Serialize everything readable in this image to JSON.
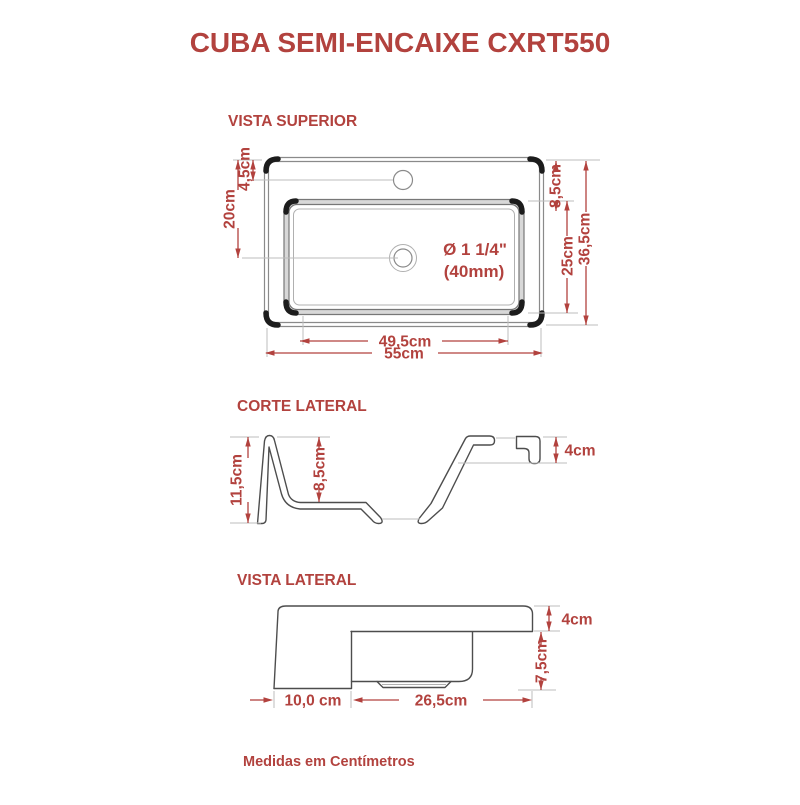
{
  "title": "CUBA SEMI-ENCAIXE CXRT550",
  "footer": "Medidas em Centímetros",
  "colors": {
    "accent_red": "#b2423e",
    "outline_dark": "#4d4d4d",
    "extension_gray": "#bdbdbd"
  },
  "top_view": {
    "heading": "VISTA SUPERIOR",
    "drain_label_line1": "Ø 1 1/4\"",
    "drain_label_line2": "(40mm)",
    "dims": {
      "faucet_offset": "4,5cm",
      "drain_offset": "20cm",
      "basin_top_offset": "8,5cm",
      "basin_depth": "25cm",
      "total_depth": "36,5cm",
      "basin_width": "49,5cm",
      "total_width": "55cm"
    }
  },
  "section_cut": {
    "heading": "CORTE LATERAL",
    "dims": {
      "total_height": "11,5cm",
      "basin_inner_depth": "8,5cm",
      "rim_height": "4cm"
    }
  },
  "side_view": {
    "heading": "VISTA LATERAL",
    "dims": {
      "rim_height": "4cm",
      "bowl_height": "7,5cm",
      "front_depth": "10,0 cm",
      "bowl_depth": "26,5cm"
    }
  }
}
